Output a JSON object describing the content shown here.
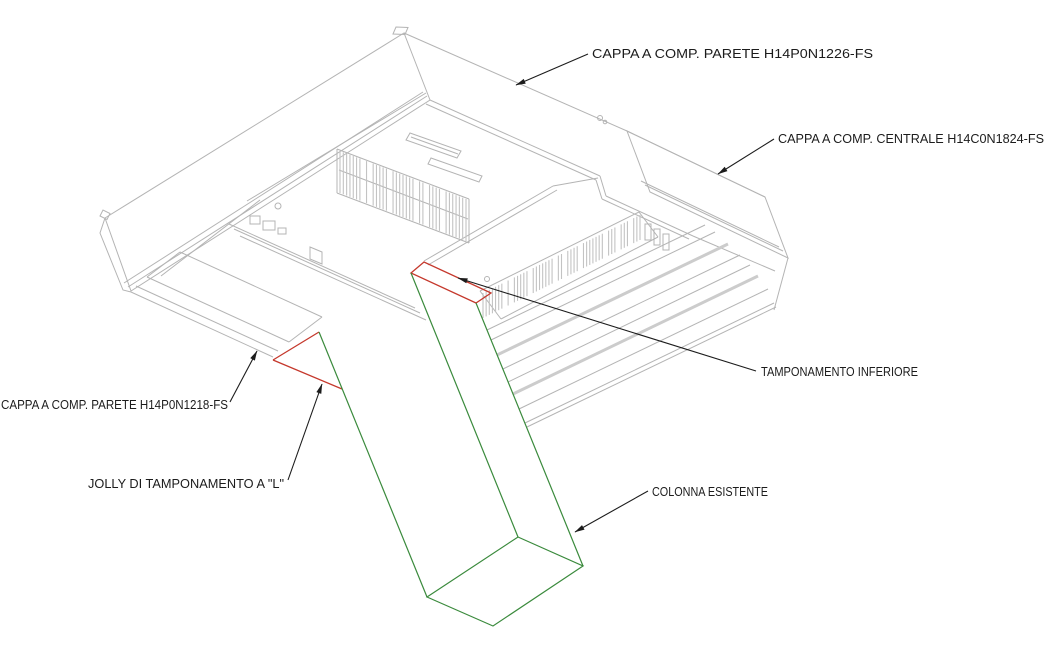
{
  "labels": {
    "cappa_parete_top": "CAPPA A COMP. PARETE H14P0N1226-FS",
    "cappa_centrale": "CAPPA A COMP. CENTRALE H14C0N1824-FS",
    "cappa_parete_left": "CAPPA A COMP. PARETE H14P0N1218-FS",
    "jolly": "JOLLY DI TAMPONAMENTO A \"L\"",
    "tamponamento_inf": "TAMPONAMENTO INFERIORE",
    "colonna": "COLONNA ESISTENTE"
  },
  "colors": {
    "background": "#ffffff",
    "drawing_lines": "#b4b4b4",
    "thick_lines": "#cccccc",
    "hatch_lines": "#c3c3c3",
    "leader_and_text": "#1c1c1c",
    "tamponamento_red": "#c5382c",
    "colonna_green": "#3a8a3c"
  }
}
